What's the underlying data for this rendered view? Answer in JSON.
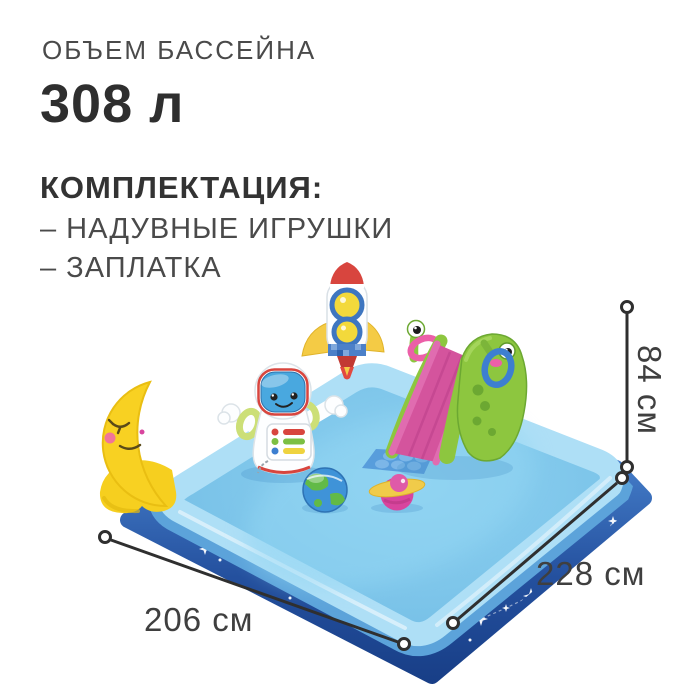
{
  "header": {
    "volume_label": "ОБЪЕМ БАССЕЙНА",
    "volume_value": "308 л",
    "kit_title": "КОМПЛЕКТАЦИЯ:",
    "kit_items": [
      "– НАДУВНЫЕ ИГРУШКИ",
      "– ЗАПЛАТКА"
    ]
  },
  "dimensions": {
    "height_label": "84 см",
    "side_right_label": "228 см",
    "side_left_label": "206 см"
  },
  "illustration": {
    "toys": [
      "crescent-moon",
      "astronaut-tumbler",
      "rocket",
      "alien-slide",
      "splash-pad",
      "earth-ball",
      "saturn-ball"
    ],
    "subject": "inflatable-space-play-pool"
  },
  "colors": {
    "text_dark": "#2e2e2e",
    "text_gray": "#4a4a4a",
    "dimension_line": "#2f2f2f",
    "pool_navy": "#1e4b9c",
    "pool_mid_blue": "#5ca3da",
    "pool_rim": "#aedff6",
    "pool_floor": "#7cc5ea",
    "moon_yellow": "#f8d122",
    "slide_pink": "#d4549d",
    "slide_green": "#8dc63f",
    "rocket_red": "#d8453e",
    "ring_blue": "#3d7fd0",
    "star_white": "#ffffff"
  }
}
